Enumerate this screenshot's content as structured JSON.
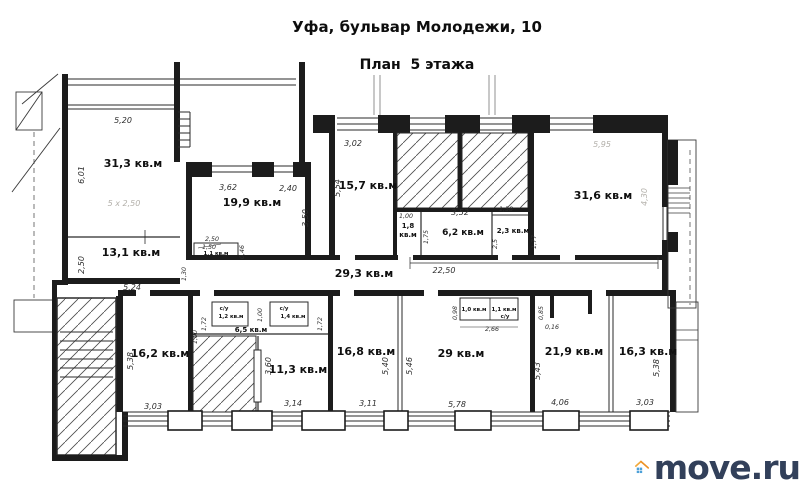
{
  "header": {
    "title": "Уфа, бульвар Молодежи, 10",
    "subtitle": "План  5 этажа"
  },
  "rooms": {
    "r31_3": "31,3 кв.м",
    "r13_1": "13,1 кв.м",
    "r19_9": "19,9 кв.м",
    "r1_1": "1,1 кв.м",
    "r15_7": "15,7 кв.м",
    "r1_8a": "1,8",
    "r1_8b": "кв.м",
    "r6_2": "6,2 кв.м",
    "r2_3": "2,3 кв.м",
    "r31_6": "31,6 кв.м",
    "r29_3": "29,3 кв.м",
    "r16_2": "16,2 кв.м",
    "r6_5": "6,5 кв.м",
    "su1": "с/у",
    "su1_area": "1,2 кв.м",
    "su2": "с/у",
    "su2_area": "1,4 кв.м",
    "r11_3": "11,3 кв.м",
    "r16_8": "16,8 кв.м",
    "r29": "29 кв.м",
    "r1_0": "1,0 кв.м",
    "r1_1b": "1,1 кв.м",
    "su3": "с/у",
    "r21_9": "21,9 кв.м",
    "r16_3": "16,3 кв.м"
  },
  "dims": {
    "d5_20": "5,20",
    "d6_01": "6,01",
    "d5x250": "5 х 2,50",
    "d2_50a": "2,50",
    "d3_62": "3,62",
    "d2_40": "2,40",
    "d3_50": "3,50",
    "d2_50b": "2,50",
    "d1_50": "1,50",
    "d0_46": "0,46",
    "d1_30": "1,30",
    "d3_02": "3,02",
    "d5_54": "5,54",
    "d1_00a": "1,00",
    "d1_75": "1,75",
    "d3_52": "3,52",
    "d1_58": "1,58",
    "d2_5": "2,5",
    "d1_77": "1,77",
    "d5_95": "5,95",
    "d4_30": "4,30",
    "d22_50": "22,50",
    "d5_24": "5,24",
    "d5_38a": "5,38",
    "d3_03a": "3,03",
    "d1_72a": "1,72",
    "d1_00b": "1,00",
    "d1_00c": "1,00",
    "d1_72b": "1,72",
    "d3_60": "3,60",
    "d3_14": "3,14",
    "d5_40": "5,40",
    "d3_11": "3,11",
    "d5_46": "5,46",
    "d5_78": "5,78",
    "d0_98": "0,98",
    "d2_66": "2,66",
    "d0_85": "0,85",
    "d0_16": "0,16",
    "d5_43": "5,43",
    "d4_06": "4,06",
    "d5_38b": "5,38",
    "d3_03b": "3,03"
  },
  "watermark": {
    "text": "move.ru",
    "roof_color": "#ec9124",
    "roof_color_light": "#f2a93b",
    "window_color": "#4ca0d8",
    "text_color": "#32405a"
  }
}
